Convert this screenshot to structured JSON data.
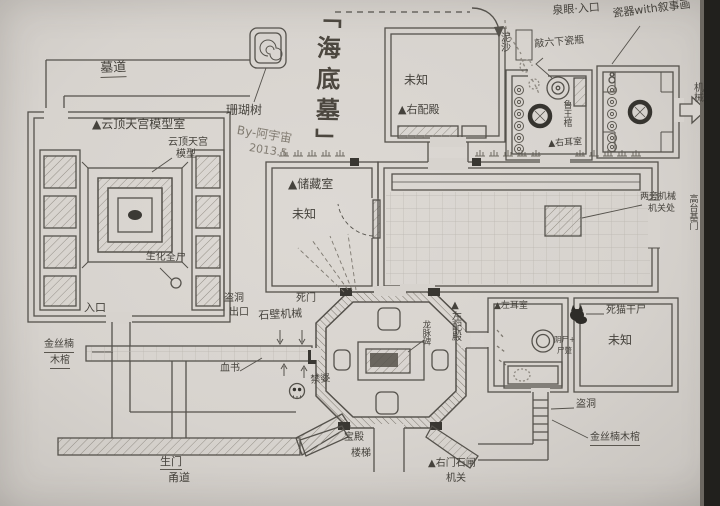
{
  "meta": {
    "title": "「海底墓」",
    "signature_line1": "By-阿宇宙",
    "signature_line2": "2013.5"
  },
  "colors": {
    "paper": "#d7d3ce",
    "pencil": "#55524c",
    "pencil_light": "#8f8a82",
    "ink_dark": "#35332f",
    "photo_edge": "#21201d"
  },
  "icons": {
    "coral_marker": "spiral-box",
    "skull": "skull-glyph",
    "black_cat": "black-cat-silhouette",
    "exit_arrow": "right-block-arrow",
    "torch": "wall-torch-tick",
    "pot": "double-ring-jar",
    "robber_hole": "thick-black-ring"
  },
  "labels": {
    "mudao": "墓道",
    "coral_tree": "珊瑚树",
    "model_room": "▲云顶天宫模型室",
    "model1": "云顶天宫",
    "model2": "模型",
    "corpse": "生化全尸",
    "entrance": "入口",
    "nanmu_left1": "金丝楠",
    "nanmu_left2": "木棺",
    "storage": "▲储藏室",
    "storage_unknown": "未知",
    "right_hall_unknown": "未知",
    "right_hall": "▲右配殿",
    "spring": "泉眼·入口",
    "sediment": "泥沙",
    "vase_note": "敲六下瓷瓶",
    "porcelain_note": "瓷器with叙事画",
    "lu_coffin": "鲁王棺",
    "right_ear": "▲右耳室",
    "exit_mech": "机械",
    "hall_note1": "两旁机械",
    "hall_note2": "机关处",
    "high_door": "高台基门",
    "stele": "龙脉碑",
    "left_hall": "▲左配殿",
    "left_ear": "▲左耳室",
    "dead_cat": "死猫干尸",
    "jar_note1": "阴尸+",
    "jar_note2": "尸蹩",
    "robber_hole": "盗洞",
    "nanmu_right": "金丝楠木棺",
    "br_unknown": "未知",
    "stairs1": "宝殿",
    "stairs2": "楼梯",
    "life1": "生门",
    "life2": "甬道",
    "right_gate1": "▲右门石闸",
    "right_gate2": "机关",
    "stone_mech": "石壁机械",
    "death_door": "死门",
    "blood_letter": "血书",
    "jinpo": "禁婆",
    "robber_exit1": "盗洞",
    "robber_exit2": "出口"
  }
}
